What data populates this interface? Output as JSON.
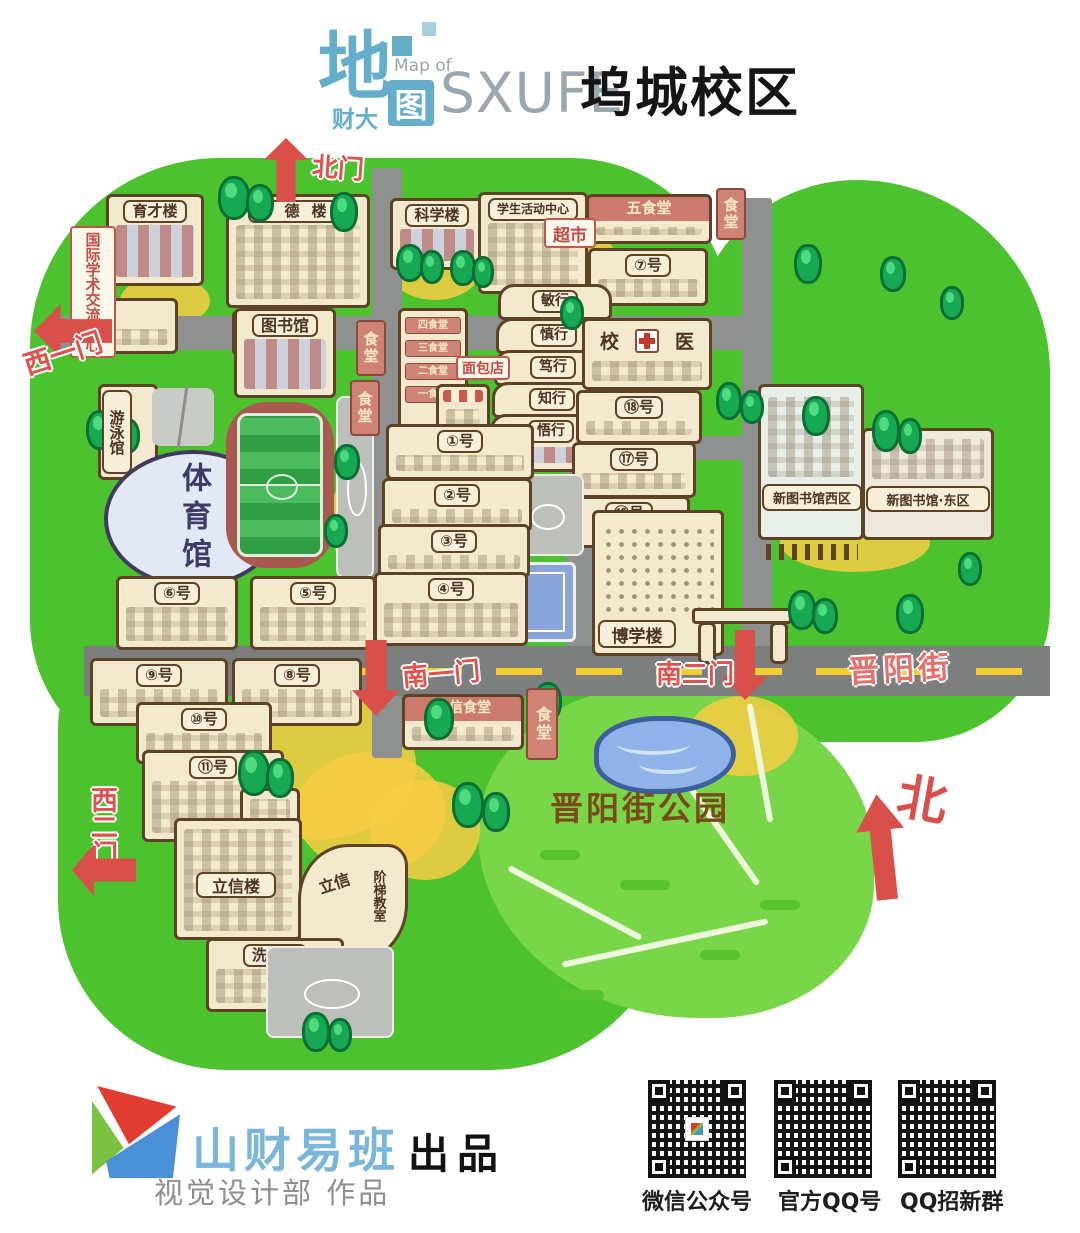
{
  "header": {
    "logo_big": "地",
    "logo_caida": "财大",
    "map_of": "Map of",
    "logo_tu": "图",
    "sxufe": "SXUFE",
    "campus": "坞城校区"
  },
  "colors": {
    "campus_green": "#4cc22f",
    "park_green": "#79d648",
    "road_gray": "#8f9190",
    "accent_red": "#d9504b",
    "title_blue": "#64aecc",
    "brand_blue": "#7ab5da",
    "sign_red": "#c24d44"
  },
  "map": {
    "gates": {
      "north": "北门",
      "west1": "西一门",
      "west2": "西二门",
      "south1": "南一门",
      "south2": "南二门"
    },
    "street_name": "晋阳街",
    "park_name": "晋阳街公园",
    "compass_north": "北",
    "buildings": {
      "yucai": "育才楼",
      "intl_center": "国际学术交流中心",
      "xiude": "修德楼",
      "kexue": "科学楼",
      "student_center": "学生活动中心",
      "supermarket": "超市",
      "canteen5": "五食堂",
      "canteen_sign": "食堂",
      "no7": "⑦号",
      "library": "图书馆",
      "canteen_floor4": "四食堂",
      "canteen_floor3": "三食堂",
      "canteen_floor2": "二食堂",
      "canteen_floor1": "一食堂",
      "bakery": "面包店",
      "minxing": "敏行",
      "shenxing": "慎行",
      "duxing": "笃行",
      "zhixing": "知行",
      "wuxing": "悟行",
      "clinic_left": "校",
      "clinic_right": "医",
      "no18": "⑱号",
      "no17": "⑰号",
      "no16": "⑯号",
      "boxue": "博学楼",
      "pool": "游泳馆",
      "gym": "体育馆",
      "no1": "①号",
      "no2": "②号",
      "no3": "③号",
      "no4": "④号",
      "no5": "⑤号",
      "no6": "⑥号",
      "no8": "⑧号",
      "no9": "⑨号",
      "no10": "⑩号",
      "no11": "⑪号",
      "lixin_canteen": "立信食堂",
      "xinlib_west": "新图书馆西区",
      "xinlib_east": "新图书馆·东区",
      "lixin_lou": "立信楼",
      "jieti_lixin": "立信",
      "jieti_rooms": "阶梯教室",
      "bath": "洗浴"
    }
  },
  "footer": {
    "brand": "山财易班",
    "produced": "出品",
    "credit": "视觉设计部 作品",
    "qr": [
      {
        "label": "微信公众号"
      },
      {
        "label": "官方QQ号"
      },
      {
        "label": "QQ招新群"
      }
    ]
  }
}
